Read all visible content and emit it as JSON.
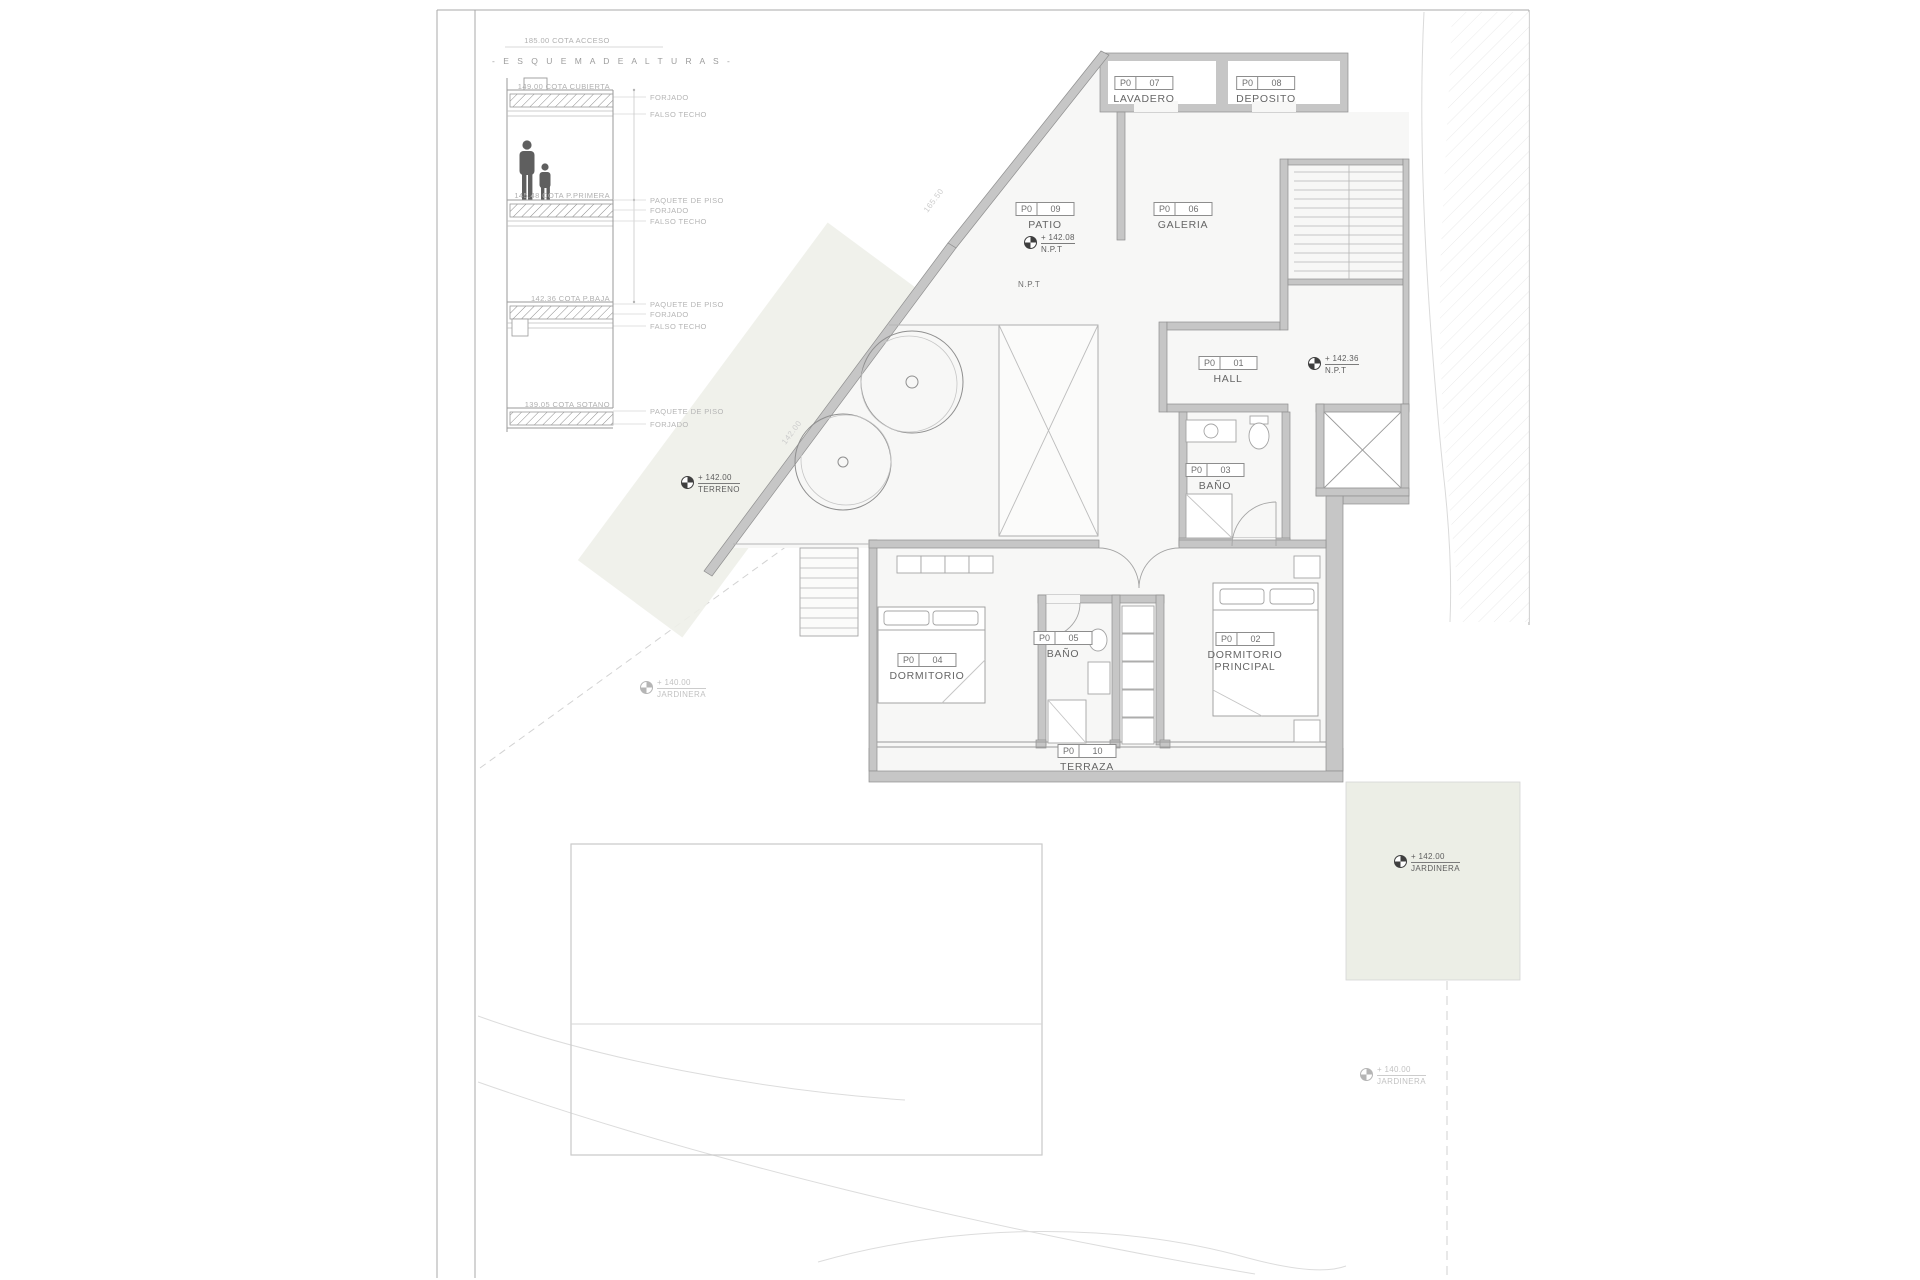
{
  "sheet": {
    "type_label": "architectural floor plan sheet",
    "colors": {
      "wall_gray": "#c6c6c6",
      "line_gray": "#9a9a9a",
      "planting_green": "#edf0e8",
      "paper": "#ffffff"
    }
  },
  "schema": {
    "access_note": "185.00 COTA ACCESO",
    "title": "-  E S Q U E M A   D E   A L T U R A S  -",
    "levels": [
      {
        "cota": "149.00 COTA CUBIERTA",
        "side": [
          "FORJADO",
          "FALSO TECHO"
        ]
      },
      {
        "cota": "145.48 COTA P.PRIMERA",
        "side": [
          "PAQUETE DE PISO",
          "FORJADO",
          "FALSO TECHO"
        ]
      },
      {
        "cota": "142.36 COTA P.BAJA",
        "side": [
          "PAQUETE DE PISO",
          "FORJADO",
          "FALSO TECHO"
        ]
      },
      {
        "cota": "139.05 COTA SOTANO",
        "side": [
          "PAQUETE DE PISO",
          "FORJADO"
        ]
      }
    ]
  },
  "rooms": [
    {
      "level": "P0",
      "number": "07",
      "name": "LAVADERO"
    },
    {
      "level": "P0",
      "number": "08",
      "name": "DEPOSITO"
    },
    {
      "level": "P0",
      "number": "09",
      "name": "PATIO"
    },
    {
      "level": "P0",
      "number": "06",
      "name": "GALERIA"
    },
    {
      "level": "P0",
      "number": "01",
      "name": "HALL"
    },
    {
      "level": "P0",
      "number": "03",
      "name": "BAÑO"
    },
    {
      "level": "P0",
      "number": "04",
      "name": "DORMITORIO"
    },
    {
      "level": "P0",
      "number": "05",
      "name": "BAÑO"
    },
    {
      "level": "P0",
      "number": "02",
      "name": "DORMITORIO",
      "name2": "PRINCIPAL"
    },
    {
      "level": "P0",
      "number": "10",
      "name": "TERRAZA"
    }
  ],
  "markers": [
    {
      "value": "+ 142.08",
      "label": "N.P.T"
    },
    {
      "value": "+ 142.36",
      "label": "N.P.T"
    },
    {
      "value": "+ 142.00",
      "label": "TERRENO"
    },
    {
      "value": "+ 142.00",
      "label": "JARDINERA"
    },
    {
      "value": "+ 140.00",
      "label": "JARDINERA"
    },
    {
      "value": "+ 140.00",
      "label": "JARDINERA"
    }
  ],
  "annotations": {
    "npt": "N.P.T",
    "lot_dim_a": "165.50",
    "lot_dim_b": "142.00"
  }
}
